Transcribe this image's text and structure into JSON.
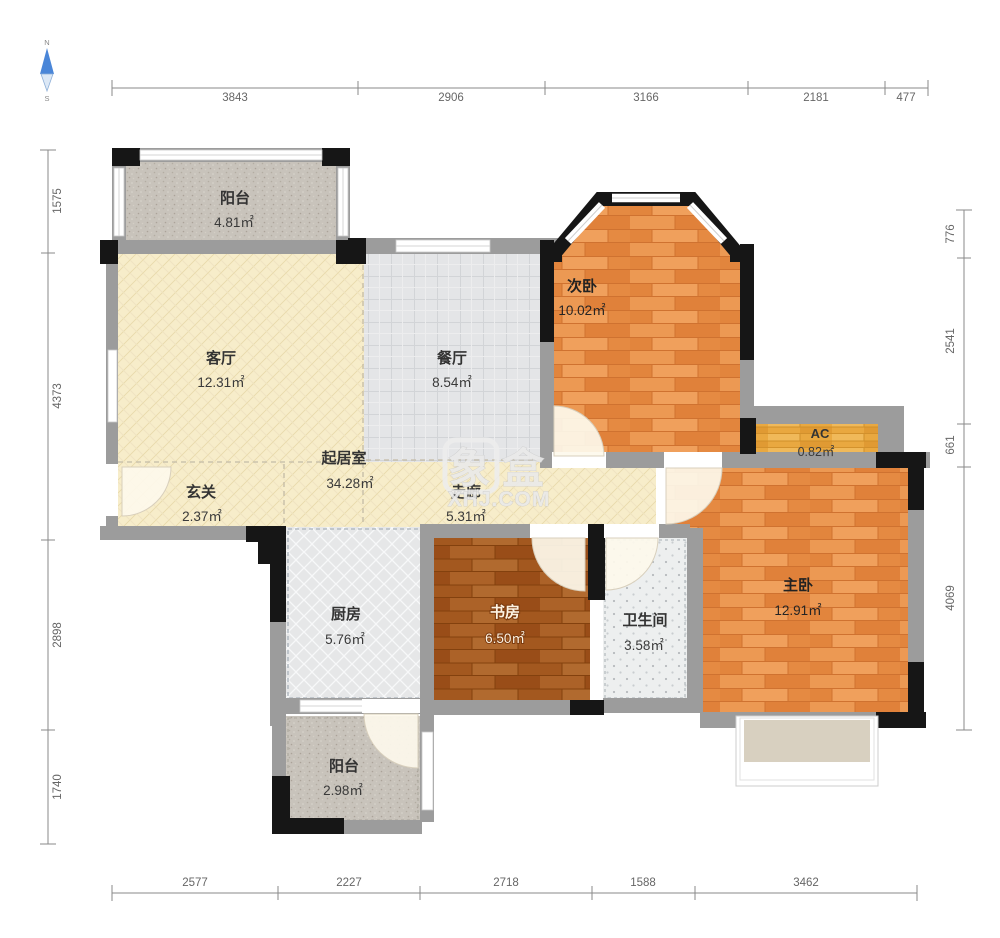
{
  "compass": {
    "north": "N",
    "south": "S"
  },
  "watermark": {
    "title": "象盒",
    "site": "XHJ.COM"
  },
  "rooms": {
    "balconyTop": {
      "name": "阳台",
      "area": "4.81㎡"
    },
    "living": {
      "name": "客厅",
      "area": "12.31㎡"
    },
    "dining": {
      "name": "餐厅",
      "area": "8.54㎡"
    },
    "livingZone": {
      "name": "起居室",
      "area": "34.28㎡"
    },
    "foyer": {
      "name": "玄关",
      "area": "2.37㎡"
    },
    "corridor": {
      "name": "走廊",
      "area": "5.31㎡"
    },
    "bedroom2": {
      "name": "次卧",
      "area": "10.02㎡"
    },
    "ac": {
      "name": "AC",
      "area": "0.82㎡"
    },
    "master": {
      "name": "主卧",
      "area": "12.91㎡"
    },
    "kitchen": {
      "name": "厨房",
      "area": "5.76㎡"
    },
    "study": {
      "name": "书房",
      "area": "6.50㎡"
    },
    "bathroom": {
      "name": "卫生间",
      "area": "3.58㎡"
    },
    "balconyBottom": {
      "name": "阳台",
      "area": "2.98㎡"
    }
  },
  "dimensions": {
    "top": [
      "3843",
      "2906",
      "3166",
      "2181",
      "477"
    ],
    "bottom": [
      "2577",
      "2227",
      "2718",
      "1588",
      "3462"
    ],
    "left": [
      "1575",
      "4373",
      "2898",
      "1740"
    ],
    "right": [
      "776",
      "2541",
      "661",
      "4069"
    ]
  },
  "colors": {
    "woodLight": "#e78b42",
    "woodDark": "#a3581f",
    "cream": "#f7edca",
    "tileGray": "#e4e5e7",
    "balconyGray": "#c8c3bb",
    "wall": "#9c9c9c",
    "column": "#161616",
    "acGold": "#e9a840",
    "compassBlue": "#4a86d8"
  }
}
